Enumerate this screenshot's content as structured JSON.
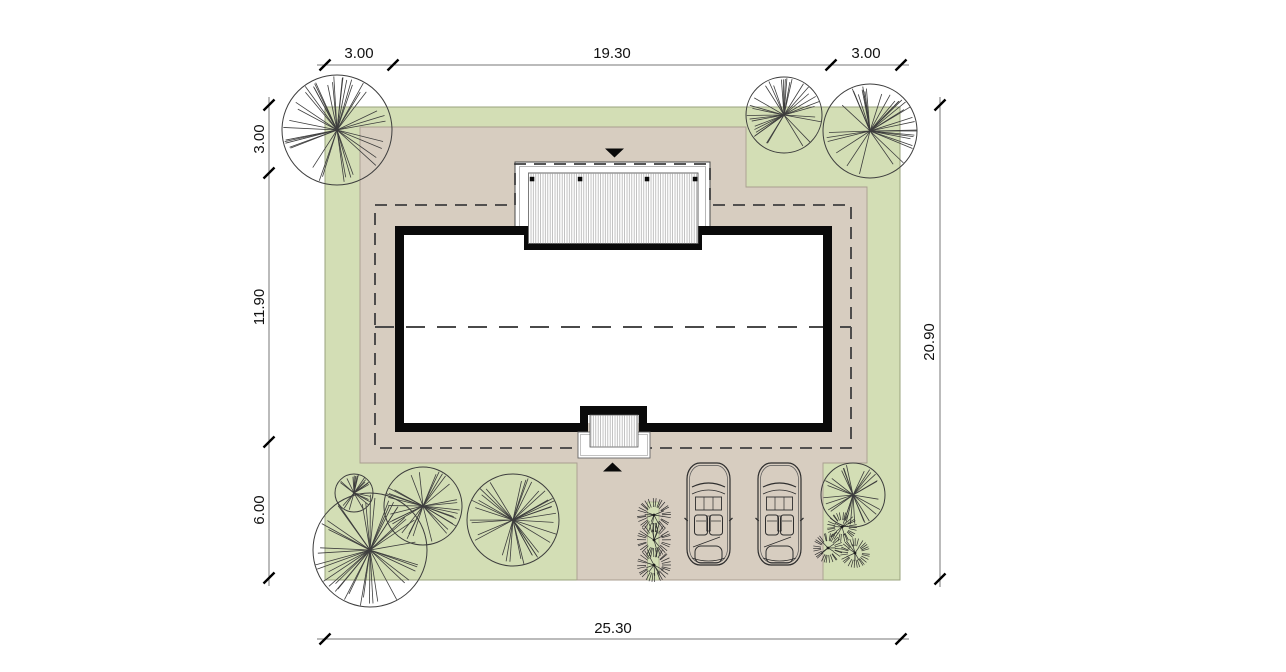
{
  "drawing": {
    "type": "architectural-site-plan",
    "colors": {
      "lawn": "#d3deb5",
      "lawn_edge": "#9aa37d",
      "paving": "#d7cdc0",
      "paving_edge": "#a89d8f",
      "wall": "#0a0a0a",
      "line": "#3d3d3d",
      "dash": "#3f3f3f",
      "dim_line": "#777777",
      "tick": "#000000",
      "white": "#ffffff",
      "hatch_line": "#9a9a9a"
    },
    "dimensions": {
      "top": {
        "labels": [
          "3.00",
          "19.30",
          "3.00"
        ]
      },
      "left": {
        "labels": [
          "3.00",
          "11.90",
          "6.00"
        ]
      },
      "right": {
        "labels": [
          "20.90"
        ]
      },
      "bottom": {
        "labels": [
          "25.30"
        ]
      }
    },
    "markers": {
      "north_entry": "triangle-down",
      "south_entry": "triangle-up"
    },
    "landscape": {
      "trees": [
        {
          "cx": 337,
          "cy": 130,
          "r": 55,
          "seed": 11
        },
        {
          "cx": 784,
          "cy": 115,
          "r": 38,
          "seed": 23
        },
        {
          "cx": 870,
          "cy": 131,
          "r": 47,
          "seed": 37
        },
        {
          "cx": 354,
          "cy": 493,
          "r": 19,
          "seed": 41
        },
        {
          "cx": 423,
          "cy": 506,
          "r": 39,
          "seed": 53
        },
        {
          "cx": 513,
          "cy": 520,
          "r": 46,
          "seed": 67
        },
        {
          "cx": 370,
          "cy": 550,
          "r": 57,
          "seed": 79
        },
        {
          "cx": 853,
          "cy": 495,
          "r": 32,
          "seed": 97
        }
      ],
      "shrubs": [
        {
          "cx": 654,
          "cy": 515,
          "r": 16,
          "seed": 3
        },
        {
          "cx": 654,
          "cy": 540,
          "r": 16,
          "seed": 5
        },
        {
          "cx": 654,
          "cy": 565,
          "r": 16,
          "seed": 7
        },
        {
          "cx": 842,
          "cy": 527,
          "r": 14,
          "seed": 13
        },
        {
          "cx": 828,
          "cy": 548,
          "r": 14,
          "seed": 17
        },
        {
          "cx": 855,
          "cy": 553,
          "r": 14,
          "seed": 19
        }
      ],
      "hedge_strip": {
        "x": 647.5,
        "y": 502,
        "w": 11.5,
        "h": 78
      }
    },
    "vehicles": {
      "count": 2,
      "cars": [
        {
          "x": 687,
          "y": 463
        },
        {
          "x": 758,
          "y": 463
        }
      ],
      "car_w": 43,
      "car_h": 102
    }
  }
}
